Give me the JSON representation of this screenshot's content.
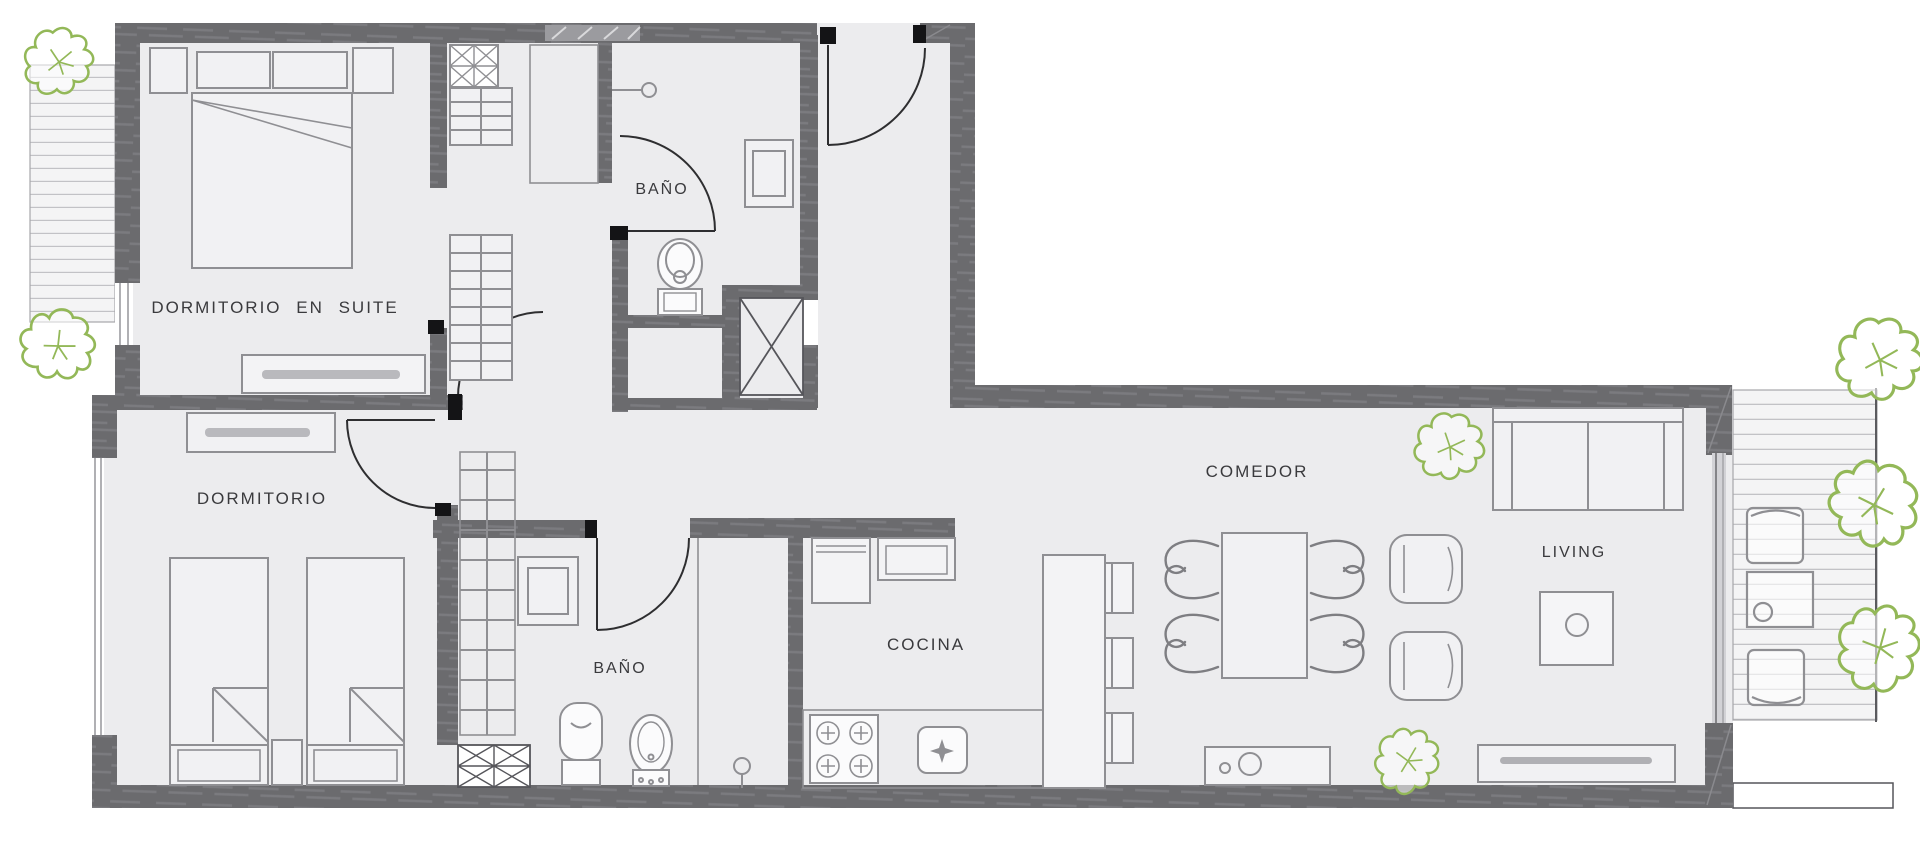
{
  "plan": {
    "title": "apartment-floor-plan",
    "rooms": [
      {
        "id": "dormitorio-en-suite",
        "label": "DORMITORIO EN SUITE"
      },
      {
        "id": "bano-suite",
        "label": "BAÑO"
      },
      {
        "id": "dormitorio",
        "label": "DORMITORIO"
      },
      {
        "id": "bano-2",
        "label": "BAÑO"
      },
      {
        "id": "cocina",
        "label": "COCINA"
      },
      {
        "id": "comedor",
        "label": "COMEDOR"
      },
      {
        "id": "living",
        "label": "LIVING"
      }
    ],
    "fixtures": [
      "double-bed",
      "single-bed",
      "single-bed",
      "nightstand",
      "dresser",
      "dresser",
      "wardrobe-shelves",
      "wardrobe-shelves",
      "wardrobe-shelves",
      "toilet",
      "toilet",
      "bidet",
      "shower",
      "shower",
      "washbasin",
      "washbasin",
      "fridge",
      "stove-4-burners",
      "kitchen-sink",
      "kitchen-island",
      "stool",
      "stool",
      "stool",
      "dining-table",
      "dining-chair",
      "dining-chair",
      "dining-chair",
      "dining-chair",
      "armchair",
      "armchair",
      "sofa",
      "coffee-table",
      "tv-console",
      "sideboard",
      "balcony-deck",
      "balcony-deck",
      "balcony-chair",
      "balcony-chair",
      "balcony-table",
      "plant",
      "plant",
      "plant",
      "plant",
      "plant",
      "plant",
      "plant"
    ],
    "colors": {
      "wall": "#6b6b6e",
      "wall_streak": "#7b7b7f",
      "floor": "#ececee",
      "deck": "#f4f4f5",
      "plank_line": "#c2c2c6",
      "furniture_line": "#8f8f93",
      "door_line": "#2e2e30",
      "door_cap": "#141416",
      "plant_green": "#93b858",
      "label_text": "#3a3a3d"
    }
  }
}
